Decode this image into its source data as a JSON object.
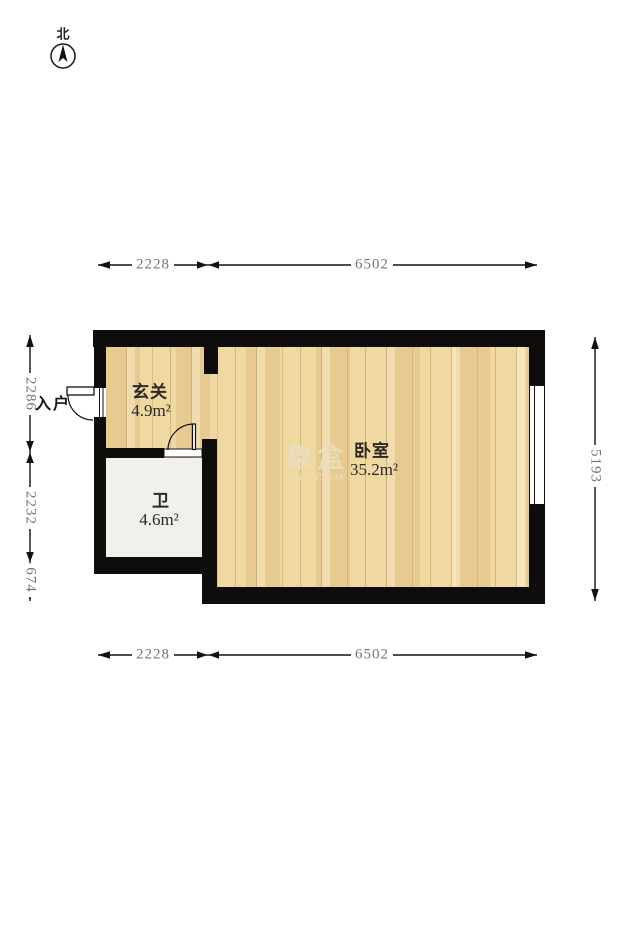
{
  "compass": {
    "label": "北"
  },
  "entrance": {
    "label": "入户"
  },
  "rooms": [
    {
      "name": "玄关",
      "area": "4.9m²"
    },
    {
      "name": "卫",
      "area": "4.6m²"
    },
    {
      "name": "卧室",
      "area": "35.2m²"
    }
  ],
  "dimensions": {
    "top": [
      "2228",
      "6502"
    ],
    "bottom": [
      "2228",
      "6502"
    ],
    "left": [
      "2286",
      "2232",
      "674"
    ],
    "right": [
      "5193"
    ]
  },
  "watermark": {
    "brand": "象盒",
    "site": "XHJ.COM"
  },
  "colors": {
    "wall": "#0e0d0b",
    "wood_floor": "#eed5a0",
    "bath_floor": "#f2f0ea",
    "dim_text": "#757575",
    "label_text": "#2b2926",
    "watermark": "#eadfc0"
  }
}
